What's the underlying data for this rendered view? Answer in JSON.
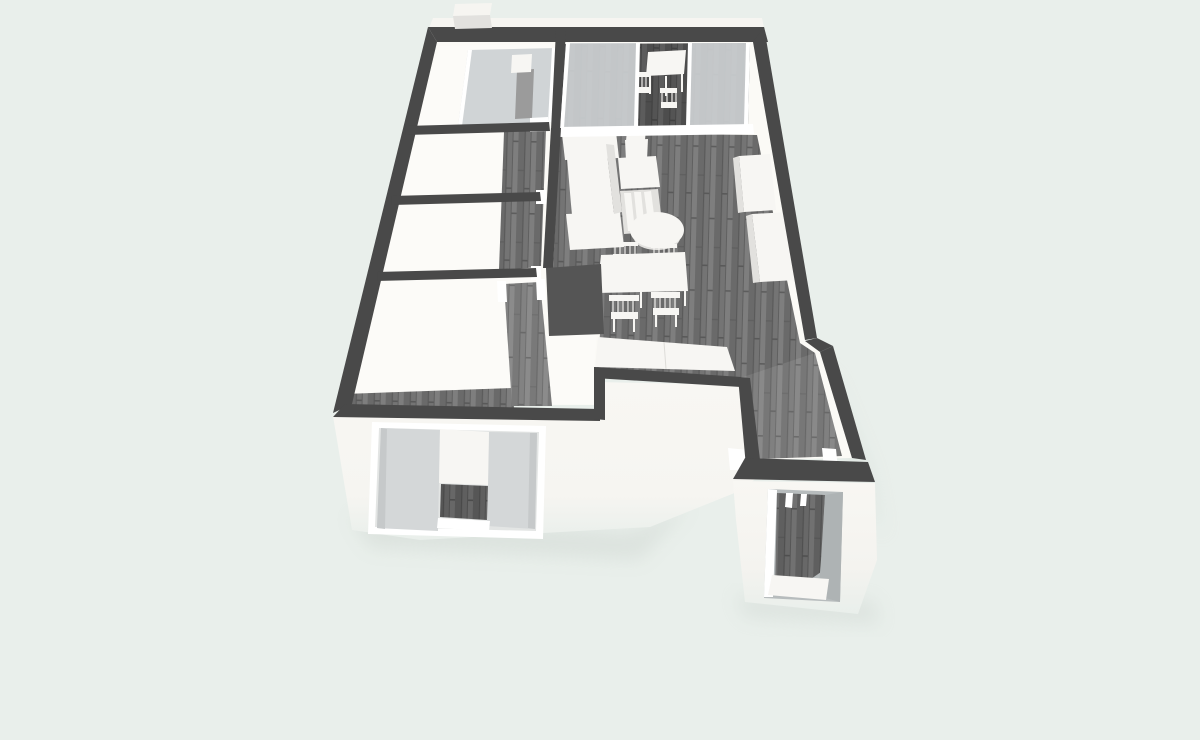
{
  "scene": {
    "kind": "3d-floorplan-render",
    "view": "perspective bird's-eye view of a one-bedroom apartment, no text or UI chrome visible",
    "palette": {
      "background": "#e9efeb",
      "wall_dark": "#494949",
      "wall_block": "#555555",
      "interior_white_base": "#fbfaf6",
      "exterior_wall_white": "#f8f7f3",
      "interior_white_floor": "#fcfbf8",
      "wood_base": "#747474",
      "wood_dark_stripe": "#626262",
      "wood_light_stripe": "#7e7e7e",
      "glass_gray": "#d0d4d6",
      "curtain_gray": "#d4d7d8",
      "furniture_white": "#f7f6f3",
      "furniture_side": "#e2e1de",
      "dresser_gray": "#9b9b9b",
      "door_jamb_gray": "#b7bcbd",
      "shadow": "#ccd4cf",
      "back_wall_highlight": "#f6f5f1"
    },
    "rooms": [
      {
        "name": "balcony",
        "floor": "dark-wood",
        "items": [
          "glass-sliding-panels",
          "outdoor-table",
          "outdoor-chairs"
        ]
      },
      {
        "name": "top-left-bedroom",
        "floor": "white",
        "items": [
          "glass-front-wardrobe",
          "dark-dresser",
          "storage-box",
          "door-frame"
        ]
      },
      {
        "name": "left-room-upper",
        "floor": "white",
        "items": []
      },
      {
        "name": "left-room-lower",
        "floor": "white",
        "items": []
      },
      {
        "name": "bottom-left-bedroom",
        "floor": "white-with-dark-wood-walkway",
        "items": [
          "door-frame"
        ]
      },
      {
        "name": "hallway",
        "floor": "dark-wood",
        "items": [
          "door-frames"
        ]
      },
      {
        "name": "living-dining-kitchen",
        "floor": "dark-wood",
        "items": [
          "kitchen-counter",
          "drawer-unit",
          "desk",
          "desk-chair",
          "round-coffee-table",
          "dining-table",
          "dining-chair",
          "dining-chair",
          "dining-chair",
          "dining-chair",
          "sideboard",
          "cabinet-block",
          "cabinet-block"
        ]
      },
      {
        "name": "entrance-vestibule",
        "floor": "dark-wood",
        "items": [
          "open-front-doorway"
        ]
      }
    ],
    "exterior": {
      "items": [
        "front-window-with-gray-curtains-and-white-blind",
        "entrance-doorway-opening",
        "rooftop-box-on-back-wall"
      ],
      "walls": "white faces below the cut-away dark wall tops, fading into soft ground shadow"
    }
  }
}
